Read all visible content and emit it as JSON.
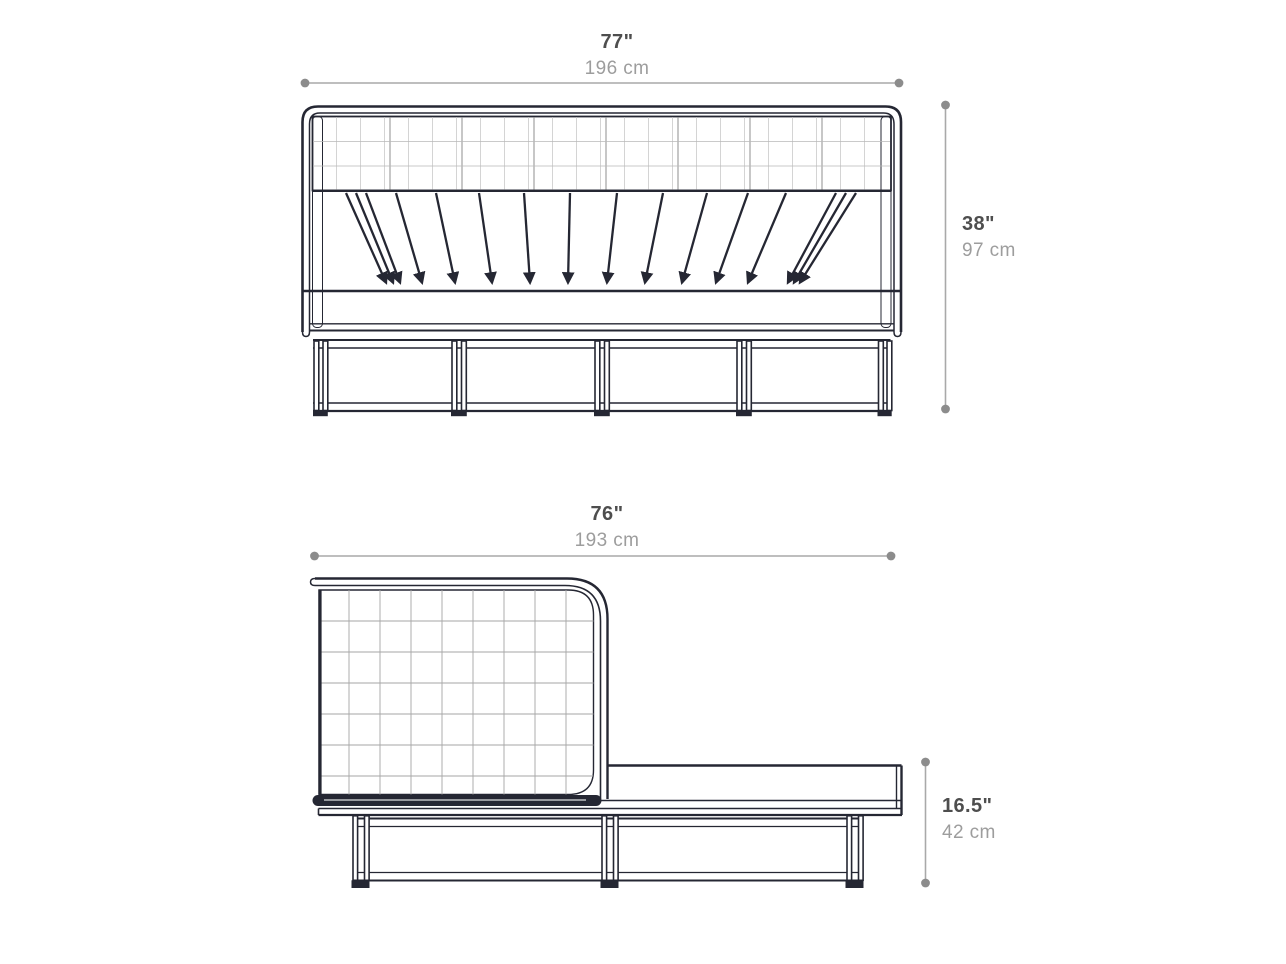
{
  "diagram": {
    "subject": "bed-technical-dimension-drawing",
    "views": [
      {
        "id": "front",
        "description": "front elevation of cane-panel bed"
      },
      {
        "id": "side",
        "description": "side elevation of cane-panel bed with platform"
      }
    ]
  },
  "dimensions": {
    "front_width": {
      "inches": "77\"",
      "cm": "196 cm"
    },
    "front_height": {
      "inches": "38\"",
      "cm": "97 cm"
    },
    "side_length": {
      "inches": "76\"",
      "cm": "193 cm"
    },
    "side_height": {
      "inches": "16.5\"",
      "cm": "42 cm"
    }
  },
  "colors": {
    "line": "#252733",
    "dimension_line": "#a9a9a9",
    "dimension_dot": "#8c8c8c",
    "inches_text": "#4e4e4e",
    "cm_text": "#9d9d9d",
    "cane_fill": "#e8e8e8",
    "background": "#ffffff"
  }
}
